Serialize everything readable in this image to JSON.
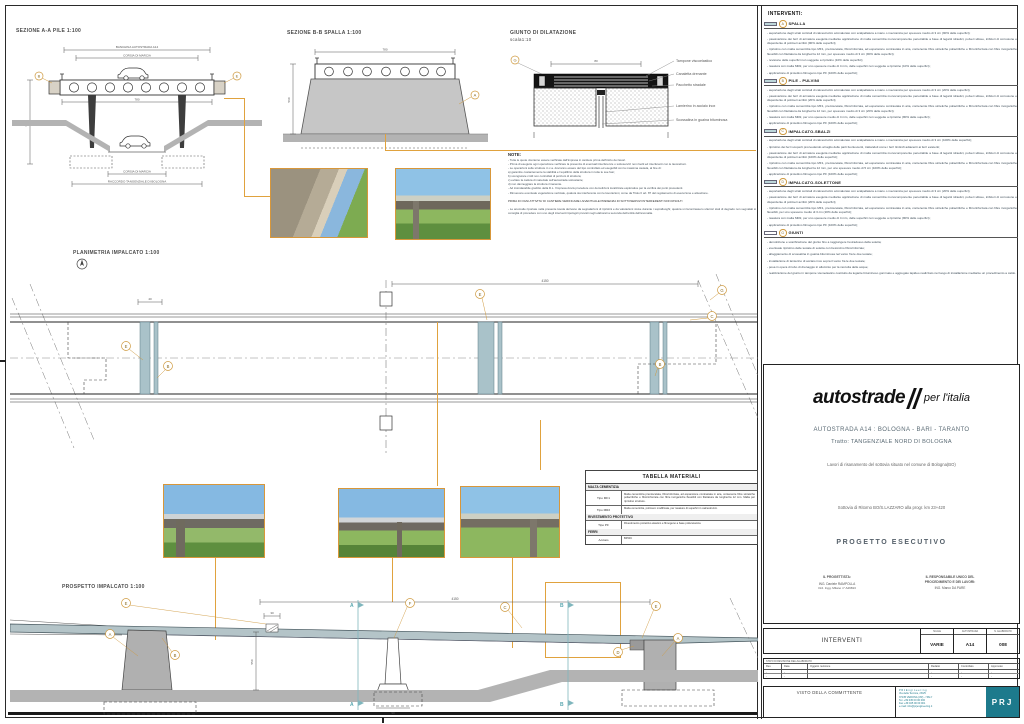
{
  "colors": {
    "accent_orange": "#e0a23e",
    "deck_teal": "#a9c2c9",
    "prj_teal": "#1d7a8c"
  },
  "drawings": {
    "sezione_aa": {
      "title": "SEZIONE A-A PILE  1:100",
      "dim_top1": "BANCHINA AUTOSTRADA A14",
      "dim_top2": "CORSIA DI MARCIA",
      "dim_deck": "780",
      "dim_h": "650",
      "dim_bottom1": "CORSIA DI MARCIA",
      "dim_bottom2": "RACCORDO TANGENZIALE DI BOLOGNA",
      "callout_left": "B",
      "callout_right": "E"
    },
    "sezione_bb": {
      "title": "SEZIONE B-B SPALLA  1:100",
      "dim_top": "780",
      "dim_h": "560",
      "callout": "A"
    },
    "giunto": {
      "title": "GIUNTO DI DILATAZIONE",
      "scale": "scala1:10",
      "callout": "G",
      "dim": "80",
      "labels": [
        "Tampone viscoelastico",
        "Canaletta drenante",
        "Pacchetto stradale",
        "Lamierino in acciaio inox",
        "Scossalina in guaina bituminosa"
      ]
    },
    "note": {
      "title": "NOTE:",
      "lines": [
        "- Tutte le quote dovranno essere verificate dall'impresa in cantiere prima dell'inizio dei lavori.",
        "- Prima di eseguire ogni operazione verificare la presenza di eventuali interferenze o sottoservizi non risolti ed interferenti con le lavorazioni.",
        "- Le operazioni sulle strutture in c.a. dovranno essere del tipo controllato ed eseguibili con la massima cautela, al fine di:",
        "a) garantire costantemente la stabilità e l'equilibrio della struttura in tutte le sue fasi;",
        "b) scongiurare crolli non controllati di porzioni di struttura;",
        "c) evitare la caduta di materiale sull'autostrada sottostante;",
        "d) non danneggiare la struttura rimanente.",
        "- Ad insindacabile giudizio della D.L. l'impresa dovrà procedere con demolizioni localizzate esplorative per la verifica dei punti precedenti.",
        "- Rimuovere eventuale vegetazione verticale, qualora sia interferente con le lavorazioni, come da Titolo II art. 87 del regolamento di esecuzione e attuazione."
      ],
      "warning": "PRIMA DI OGNI ATTIVITA' DI CANTIERE VERIFICARE L'EVENTUALE PRESENZA DI SOTTOSERVIZI INTERFERENTI NON RISOLTI",
      "footer": "- Le anomalie riportate nella presente tavola derivano da segnalazioni di ripristini e da valutazioni visive durante i sopralluoghi; qualora si riscontrassero ulteriori stati di degrado non segnalati si consiglia di procedere con uno degli interventi tipologici previsti negli elaborati a seconda dell'entità dell'anomalia."
    },
    "planimetria": {
      "title": "PLANIMETRIA IMPALCATO  1:100",
      "dim": "4150",
      "dim_small": "40",
      "co1": "E",
      "co2": "B",
      "co3": "E",
      "co4": "C",
      "co5": "B",
      "co6": "G"
    },
    "prospetto": {
      "title": "PROSPETTO IMPALCATO  1:100",
      "dim_top": "4150",
      "dim_h": "550",
      "dim_j": "30",
      "dim_base": "90",
      "marker_a": "A",
      "marker_b": "B",
      "co_e1": "E",
      "co_a1": "A",
      "co_b": "B",
      "co_f": "F",
      "co_c": "C",
      "co_e2": "E",
      "co_d": "D",
      "co_a2": "A"
    },
    "tabella": {
      "title": "TABELLA MATERIALI",
      "group1": "MALTA CEMENTIZIA",
      "rows1": [
        {
          "tipo": "Tipo MF1",
          "desc": "Malta cementizia premiscelata, fibrorinforzata, ad espansione contrastata in aria, contenente fibre sintetiche poliacriliche e fibrorinforzata con fibre inorganiche flessibili con filettatura da lunghezza 12 mm. Malta per ripristino strutture."
        },
        {
          "tipo": "Tipo MR2",
          "desc": "Malta cementizia, polimero modificata, per rasature di superfici in calcestruzzo."
        }
      ],
      "group2": "RIVESTIMENTO PROTETTIVO",
      "rows2": [
        {
          "tipo": "Tipo PF",
          "desc": "Rivestimento protettivo elastico e filmogeno a base poliuretanica"
        }
      ],
      "group3": "FERRI",
      "rows3": [
        {
          "tipo": "Acciaio",
          "desc": "B450C"
        }
      ]
    }
  },
  "interventi": {
    "title": "INTERVENTI:",
    "spalla": {
      "letter": "A",
      "title": "SPALLA",
      "bullets": [
        "- asportazione degli strati corticali di calcestruzzo ammalorato con scalpellatura a mano o meccanica per spessore medio di 3 cm (90% delle superfici);",
        "- passivazione dei ferri di armatura eseguita mediante applicazione di malta cementizia monocomponente penetrabile a base di leganti idraulici, polveri silicee, inibitori di corrosione e disperdente di polimeri acrilici (90% delle superfici);",
        "- ripristino con malta cementizia tipo MF1, premiscelata, fibrorinforzata, ad espansione contrastata in aria, contenente fibre sintetiche poliacriliche e fibrorinforzata con fibre inorganiche flessibili con filettatura da lunghezza 12 mm, per spessore medio di 3 cm (90% delle superfici);",
        "- revisione delle superfici non soggette a ripristino (10% delle superfici);",
        "- rasatura con malta MR2, per uno spessore medio di 4 mm, delle superfici non soggette a ripristino (10% delle superfici);",
        "- applicazione di protettivo filmogeno tipo PF (100% delle superfici);"
      ]
    },
    "pile": {
      "letter": "B",
      "title": "PILE - PULVINI",
      "bullets": [
        "- asportazione degli strati corticali di calcestruzzo ammalorato con scalpellatura a mano o meccanica per spessore medio di 3 cm (20% delle superfici);",
        "- passivazione dei ferri di armatura eseguita mediante applicazione di malta cementizia monocomponente penetrabile a base di leganti idraulici, polveri silicee, inibitori di corrosione e disperdente di polimeri acrilici (20% delle superfici);",
        "- ripristino con malta cementizia tipo MF1, premiscelata, fibrorinforzata, ad espansione contrastata in aria, contenente fibre sintetiche poliacriliche e fibrorinforzata con fibre inorganiche flessibili con filettatura da lunghezza 12 mm, per spessore medio di 3 cm (20% delle superfici);",
        "- rasatura con malta MR2, per uno spessore medio di 4 mm, delle superfici non soggette a ripristino (80% delle superfici);",
        "- applicazione di protettivo filmogeno tipo PF (100% delle superfici);"
      ]
    },
    "sbalzi": {
      "letter": "C",
      "title": "IMPALCATO-SBALZI",
      "bullets": [
        "- asportazione degli strati corticali di calcestruzzo ammalorato con scalpellatura a mano o meccanica per spessore medio di 3 cm (100% delle superfici);",
        "- ripristino dei ferri scoperti provvedendo al taglio delle parti fuoriuscenti, trattandoli come i ferri limitrofi adiacenti ai ferri esistenti;",
        "- passivazione dei ferri di armatura eseguita mediante applicazione di malta cementizia monocomponente penetrabile a base di leganti idraulici, polveri silicee, inibitori di corrosione e disperdente di polimeri acrilici (100% delle superfici);",
        "- ripristino con malta cementizia tipo MF1, premiscelata, fibrorinforzata, ad espansione contrastata in aria, contenente fibre sintetiche poliacriliche e fibrorinforzata con fibre inorganiche flessibili con filettatura da lunghezza 12 mm, per uno spessore medio di 5 cm (100% delle superfici);",
        "- applicazione di protettivo filmogeno tipo PF (100% delle superfici);"
      ]
    },
    "solettone": {
      "letter": "D",
      "title": "IMPALCATO-SOLETTONE",
      "bullets": [
        "- asportazione degli strati corticali di calcestruzzo ammalorato con scalpellatura a mano o meccanica per spessore medio di 3 cm (20% delle superfici);",
        "- passivazione dei ferri di armatura eseguita mediante applicazione di malta cementizia monocomponente penetrabile a base di leganti idraulici, polveri silicee, inibitori di corrosione e disperdente di polimeri acrilici (20% delle superfici);",
        "- ripristino con malta cementizia tipo MF1, premiscelata, fibrorinforzata, ad espansione contrastata in aria, contenente fibre sintetiche poliacriliche e fibrorinforzata con fibre inorganiche flessibili, per uno spessore medio di 3 cm (20% delle superfici);",
        "- rasatura con malta MR2, per uno spessore medio di 4 mm, delle superfici non soggette a ripristino (80% delle superfici);",
        "- applicazione di protettivo filmogeno tipo PF (100% delle superfici);"
      ]
    },
    "giunti": {
      "letter": "G",
      "title": "GIUNTI",
      "bullets": [
        "- demolizione e scarificazione del giunto fino a raggiungere l'estradosso della soletta;",
        "- eventuale ripristino delle testate di soletta con betoncino fibrorinforzato;",
        "- alloggiamento di scossalina in guaina bituminosa nel varco fra le due testate;",
        "- installazione di lamierino di acciaio inox sopra il varco fra le due testate;",
        "- posa in opera di tubo di drenaggio in alluminio per la raccolta delle acque;",
        "- realizzazione del giunto in tampone viscoelastico costituito da legante bituminoso gommato e aggregato lapideo realizzato nel luogo di installazione mediante un procedimento a caldo."
      ]
    }
  },
  "titleblock": {
    "logo_main": "autostrade",
    "logo_sub": "per l'italia",
    "road": "AUTOSTRADA A14 : BOLOGNA - BARI - TARANTO",
    "tratto": "Tratto: TANGENZIALE NORD DI BOLOGNA",
    "works": "Lavori di risanamento del sottovia situato nel comune di Bologna(BO)",
    "subject": "Sottovia di Ritorno BO/S.LAZZARO alla progr. km 23+420",
    "phase": "PROGETTO ESECUTIVO",
    "designer_title": "IL PROGETTISTA:",
    "designer_name": "ING. Daniele RAMPOLLA",
    "designer_reg": "Ord. Ingg. Milano n° A29813",
    "rup_title1": "IL RESPONSABILE UNICO DEL",
    "rup_title2": "PROCEDIMENTO E DEI LAVORI:",
    "rup_name": "ING. Marco DA PARE"
  },
  "bottom": {
    "title": "INTERVENTI",
    "col1_h": "SCALE",
    "col1_v": "VARIE",
    "col2_h": "AUTOSTRADA",
    "col2_v": "A14",
    "col3_h": "N. ELABORATO",
    "col3_v": "008",
    "rev_caption": "STATO DI REVISIONE DELL'ELABORATO",
    "rev_headers": {
      "c1": "Rev.",
      "c2": "Data",
      "c3": "Oggetto revisione",
      "c4": "Redatto",
      "c5": "Controllato",
      "c6": "Approvato"
    },
    "rev_rows": [
      {
        "c1": "-",
        "c2": "-",
        "c3": "",
        "c4": "-",
        "c5": "-",
        "c6": "-"
      },
      {
        "c1": "-",
        "c2": "-",
        "c3": "",
        "c4": "-",
        "c5": "-",
        "c6": "-"
      }
    ],
    "visto": "VISTO DELLA COMMITTENTE",
    "prj_lines": [
      "P R J   E n g i n e e r i n g",
      "Via della Tecnica, 23/25",
      "37135 VERONA (VR) - ITALY",
      "Tel.  +39 045 00 00 000",
      "Fax  +39 045 00 00 001",
      "e-mail: info@prjengineering.it"
    ],
    "prj_logo": "PRJ"
  }
}
